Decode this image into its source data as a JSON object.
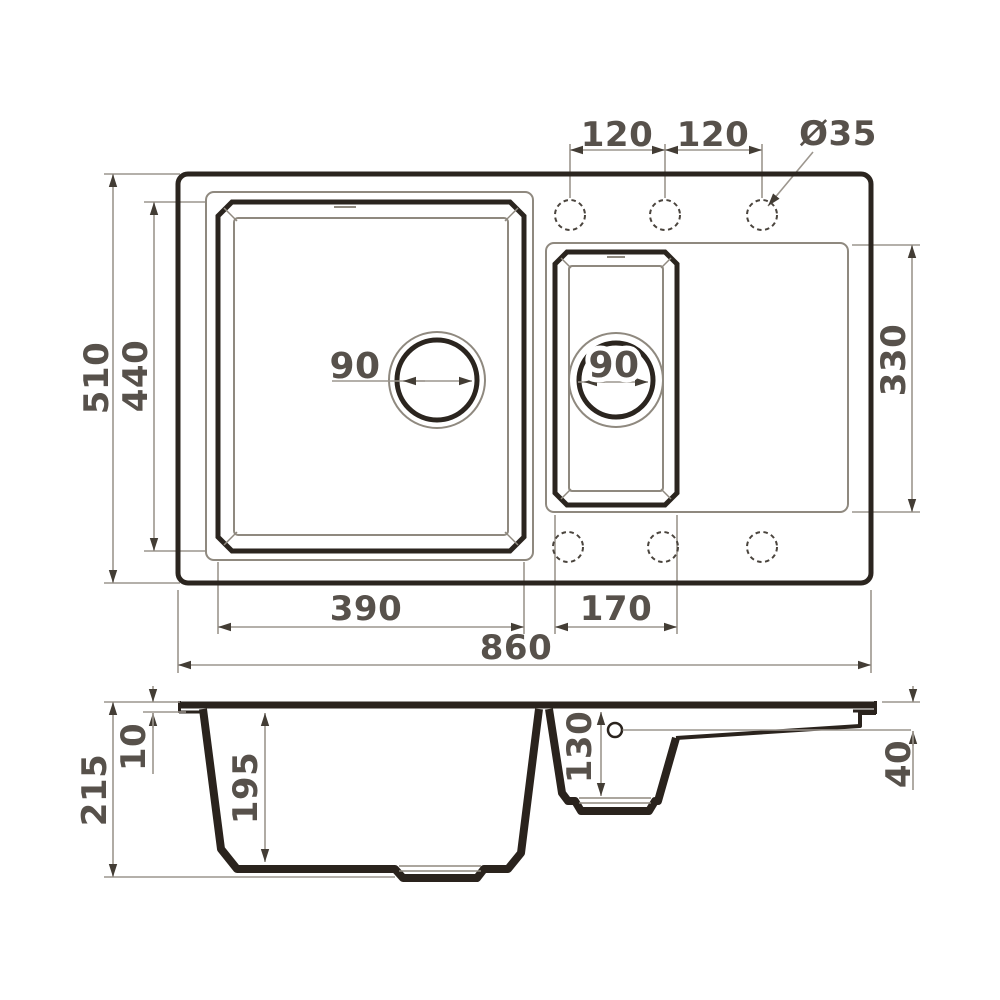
{
  "drawing": {
    "background": "#ffffff",
    "colors": {
      "thick_outline": "#2b251f",
      "thin_outline": "#8f897f",
      "dimension_line": "#9c968e",
      "arrow": "#433d35",
      "text": "#57514b",
      "section_solid": "#2a231d",
      "dashed_hole": "#4a443d"
    },
    "top_view": {
      "dims": {
        "total_width": "860",
        "total_height": "510",
        "main_bowl_width": "390",
        "main_bowl_height": "440",
        "small_bowl_width": "170",
        "small_bowl_height": "330",
        "hole_pitch_left": "120",
        "hole_pitch_right": "120",
        "faucet_hole_diameter": "Ø35",
        "main_drain_diameter": "90",
        "small_drain_diameter": "90"
      }
    },
    "section_view": {
      "dims": {
        "total_height": "215",
        "rim_thickness": "10",
        "main_bowl_depth": "195",
        "small_bowl_depth": "130",
        "right_edge_depth": "40"
      }
    }
  }
}
